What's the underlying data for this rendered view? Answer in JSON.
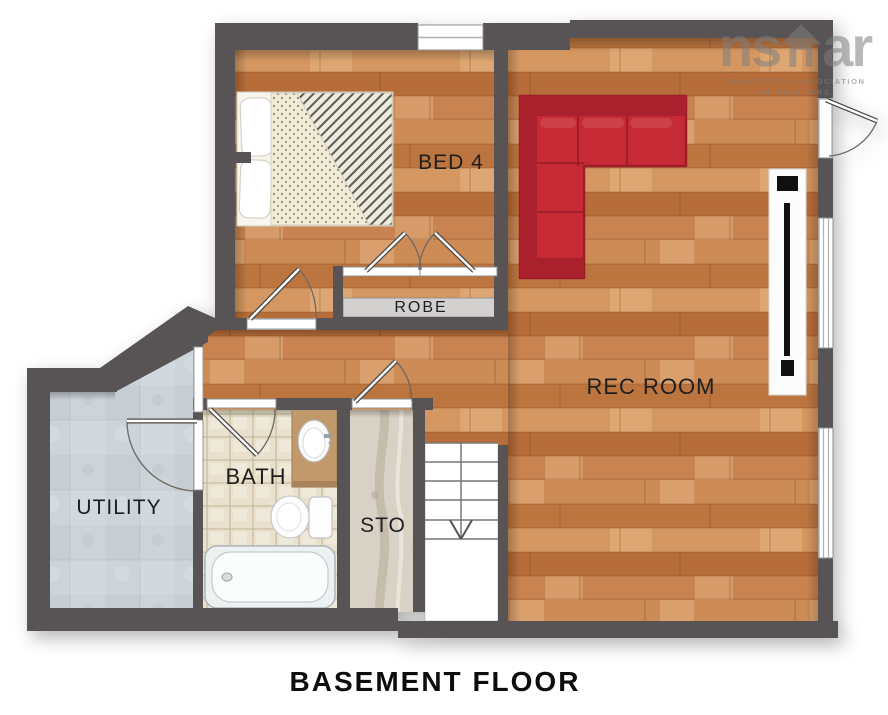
{
  "plan": {
    "title": "BASEMENT FLOOR",
    "rooms": {
      "bed4": "BED 4",
      "rec": "REC ROOM",
      "utility": "UTILITY",
      "bath": "BATH",
      "sto": "STO",
      "robe": "ROBE"
    },
    "logo": {
      "left": "ns",
      "right": "ar",
      "line1": "NOVA SCOTIA ASSOCIATION",
      "line2": "OF REALTORS"
    },
    "colors": {
      "wall": "#585355",
      "wood": "#c9854e",
      "sofa_red": "#c62b35",
      "sofa_red_dark": "#aa202d",
      "bath_tile": "#e9e1cd",
      "utility_floor": "#ccd4d9",
      "sto_floor": "#d8d1c6",
      "logo_gray": "#808080"
    }
  }
}
